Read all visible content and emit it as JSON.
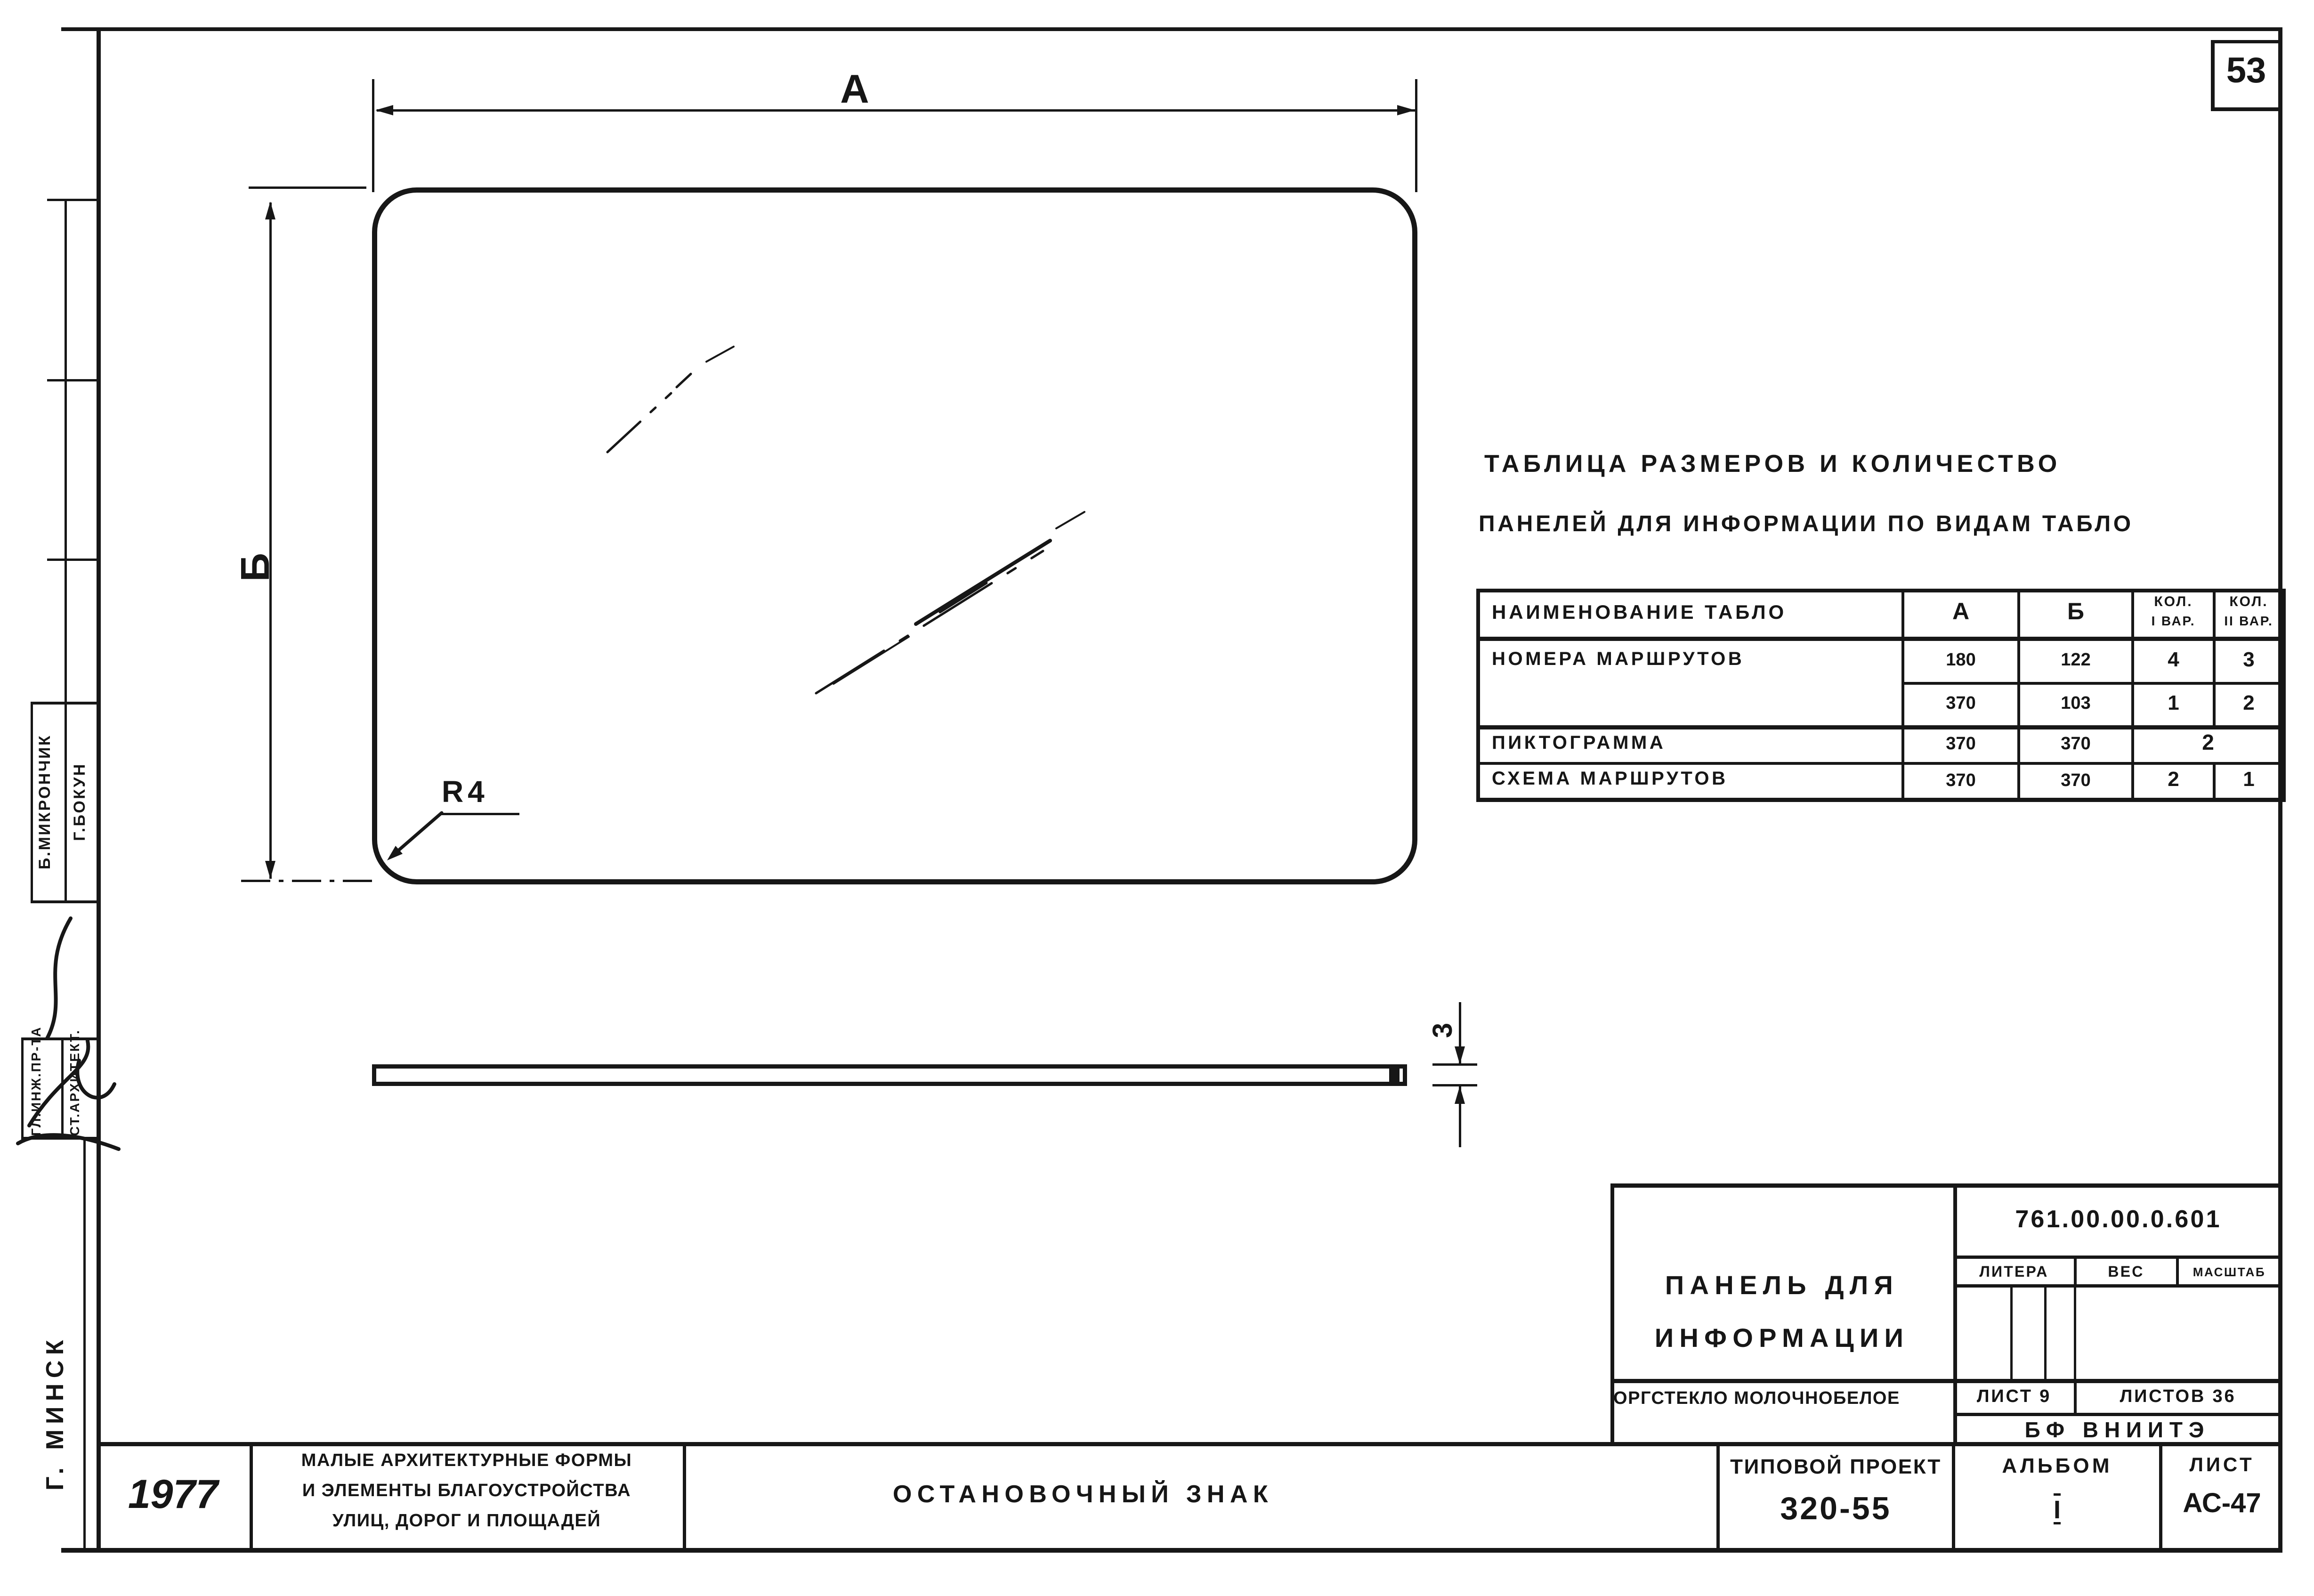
{
  "ink": "#171717",
  "sheet_number": "53",
  "drawing": {
    "dim_width_label": "А",
    "dim_height_label": "Б",
    "radius_label": "R4",
    "thickness_label": "3"
  },
  "size_table": {
    "title_line1": "Таблица размеров и количество",
    "title_line2": "панелей для информации по видам табло",
    "col_name": "Наименование табло",
    "col_a": "А",
    "col_b": "Б",
    "col_q1_line1": "Кол.",
    "col_q1_line2": "I вар.",
    "col_q2_line1": "Кол.",
    "col_q2_line2": "II вар.",
    "rows": [
      {
        "name": "Номера маршрутов",
        "a": "180",
        "b": "122",
        "q1": "4",
        "q2": "3"
      },
      {
        "name": "",
        "a": "370",
        "b": "103",
        "q1": "1",
        "q2": "2"
      },
      {
        "name": "Пиктограмма",
        "a": "370",
        "b": "370",
        "q_merged": "2"
      },
      {
        "name": "Схема маршрутов",
        "a": "370",
        "b": "370",
        "q1": "2",
        "q2": "1"
      }
    ]
  },
  "title_block": {
    "title_line1": "Панель для",
    "title_line2": "информации",
    "doc_number": "761.00.00.0.601",
    "litera_label": "Литера",
    "weight_label": "Вес",
    "scale_label": "Масштаб",
    "material": "Оргстекло молочнобелое",
    "sheet_label": "Лист 9",
    "sheets_label": "Листов 36",
    "org": "БФ ВНИИТЭ"
  },
  "footer": {
    "year": "1977",
    "series_line1": "Малые архитектурные формы",
    "series_line2": "и элементы благоустройства",
    "series_line3": "улиц, дорог и площадей",
    "drawing_title": "Остановочный знак",
    "project_label": "Типовой проект",
    "project_number": "320-55",
    "album_label": "Альбом",
    "album_number": "I",
    "sheet_label": "Лист",
    "sheet_number": "АС-47"
  },
  "stamp_column": {
    "name1": "Б.Микрончик",
    "name2": "Г.Бокун",
    "role1": "Гл.инж.пр-та",
    "role2": "Ст.архитект.",
    "city": "г. Минск"
  }
}
